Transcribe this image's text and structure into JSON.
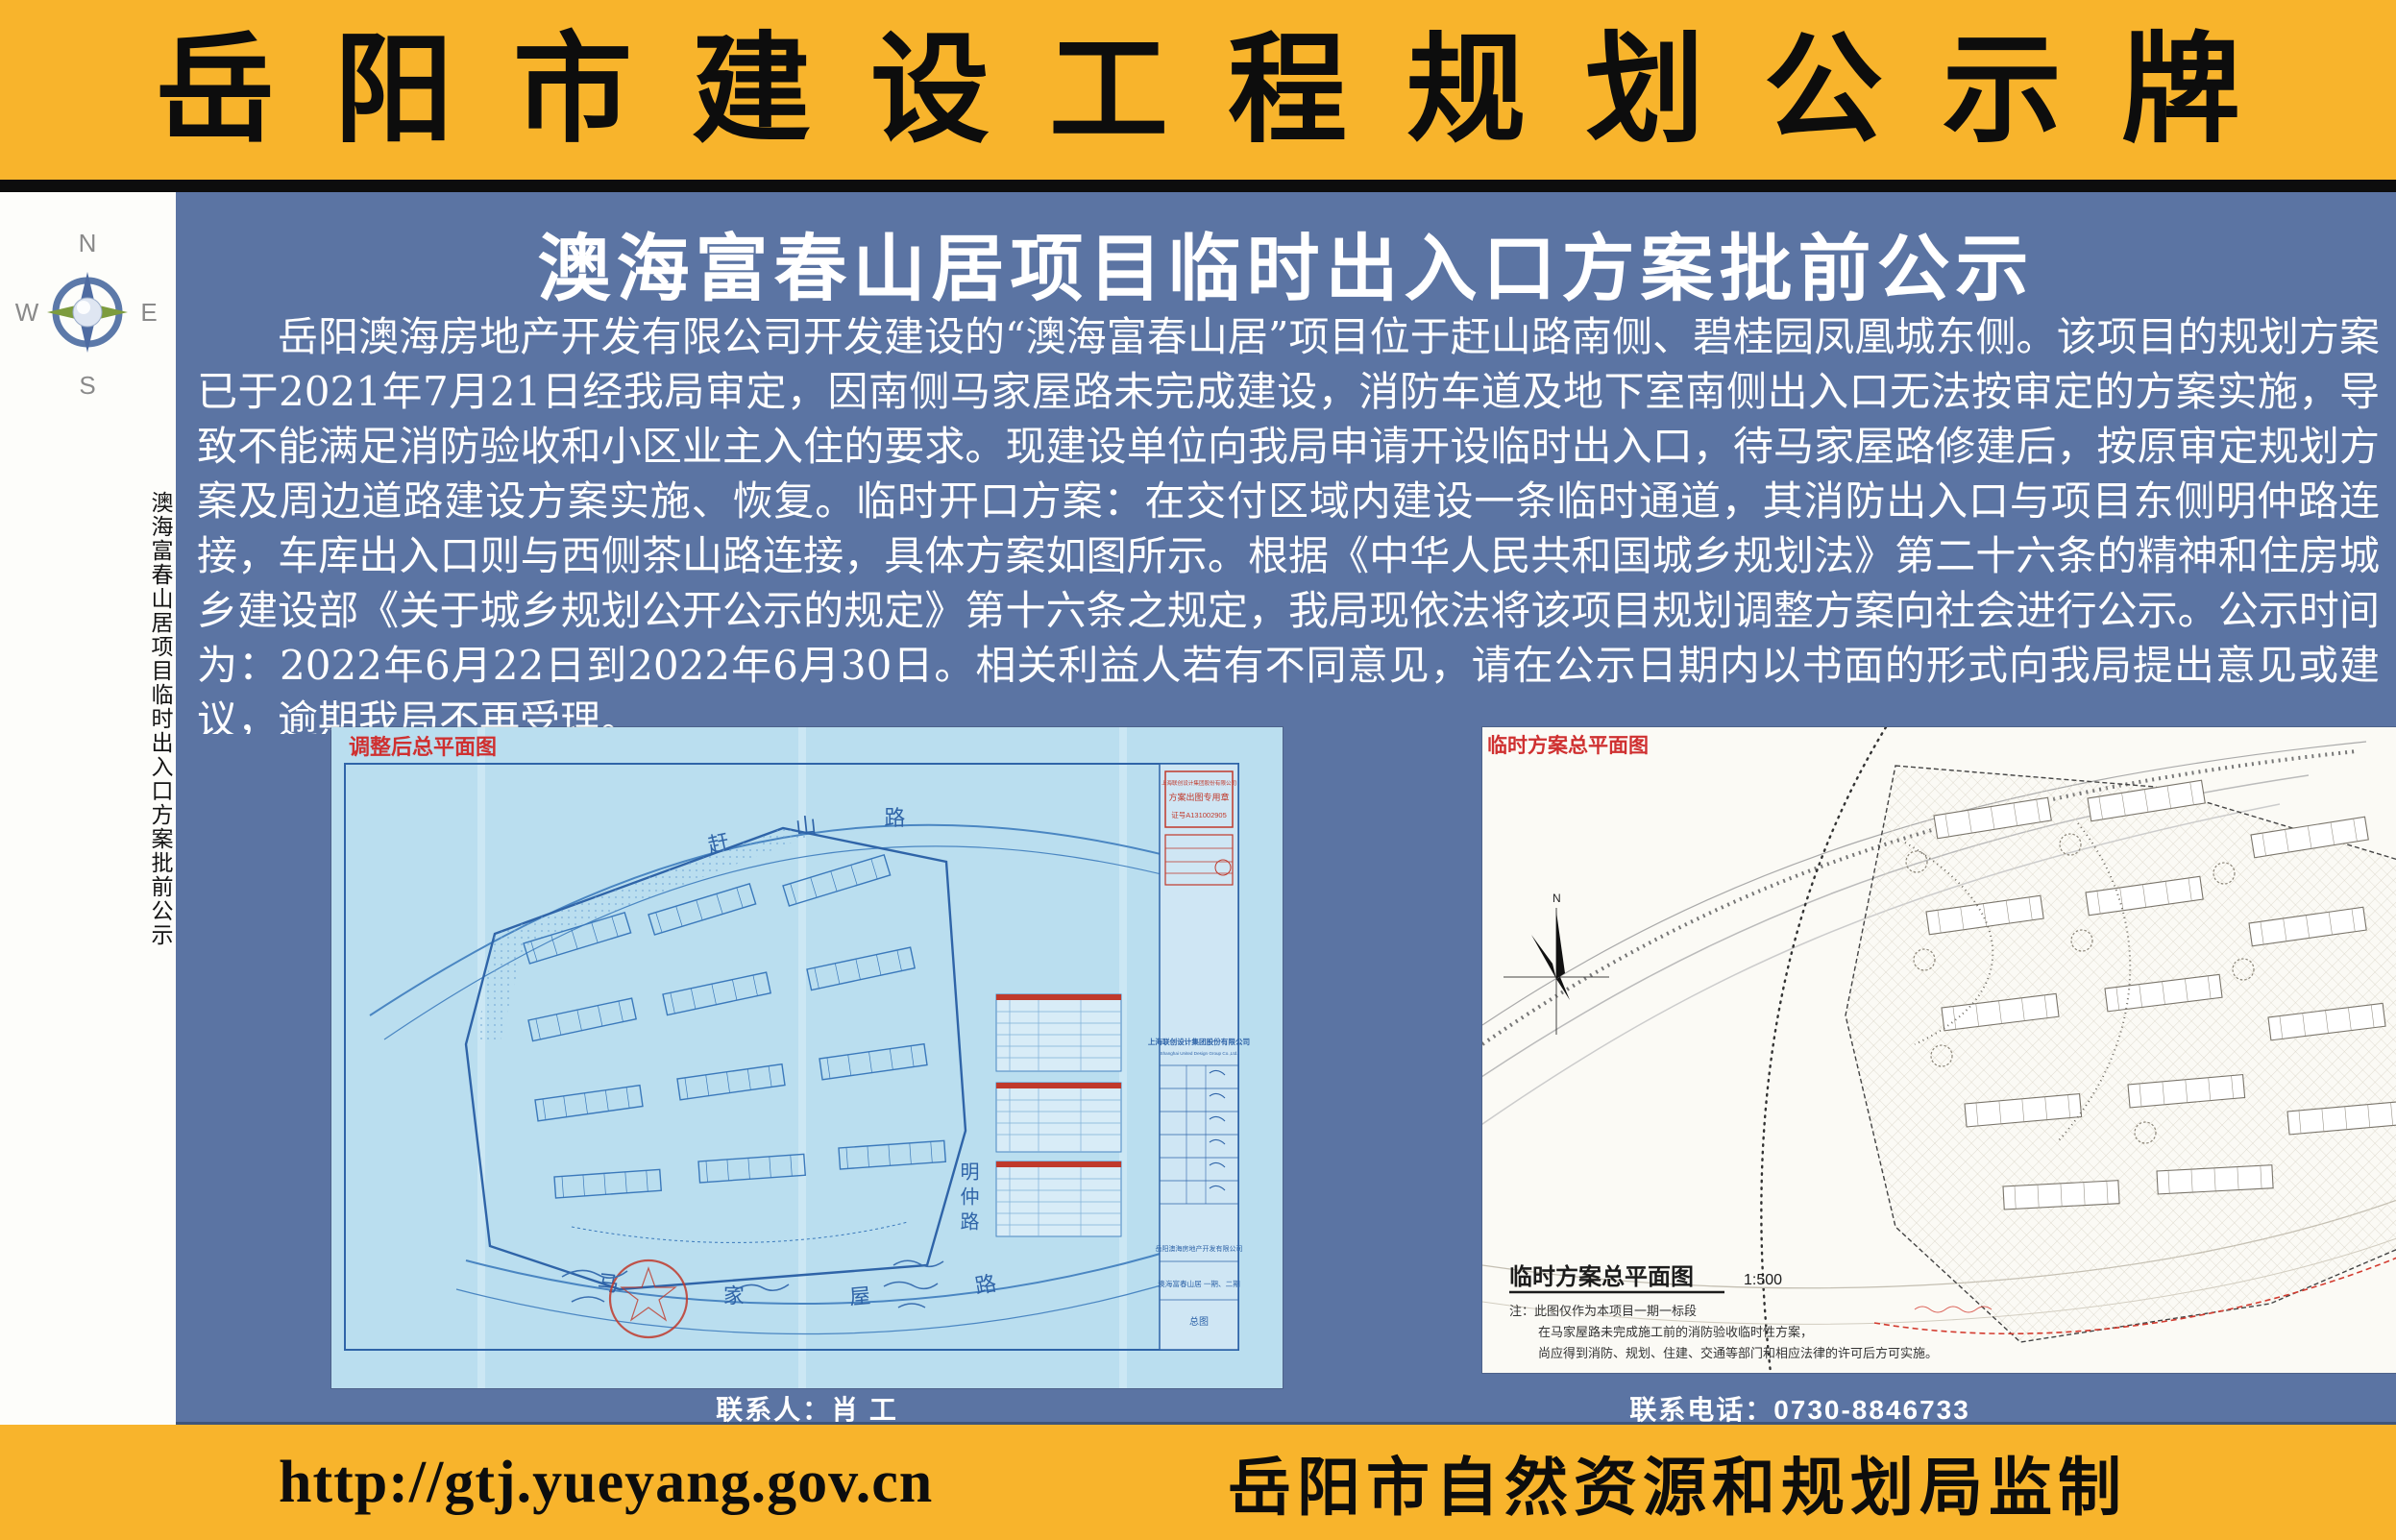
{
  "header": {
    "title": "岳阳市建设工程规划公示牌"
  },
  "sidebar": {
    "vertical_title": "澳海富春山居项目临时出入口方案批前公示",
    "compass": {
      "n": "N",
      "e": "E",
      "s": "S",
      "w": "W"
    }
  },
  "notice": {
    "subtitle": "澳海富春山居项目临时出入口方案批前公示",
    "body": "岳阳澳海房地产开发有限公司开发建设的“澳海富春山居”项目位于赶山路南侧、碧桂园凤凰城东侧。该项目的规划方案已于2021年7月21日经我局审定，因南侧马家屋路未完成建设，消防车道及地下室南侧出入口无法按审定的方案实施，导致不能满足消防验收和小区业主入住的要求。现建设单位向我局申请开设临时出入口，待马家屋路修建后，按原审定规划方案及周边道路建设方案实施、恢复。临时开口方案：在交付区域内建设一条临时通道，其消防出入口与项目东侧明仲路连接，车库出入口则与西侧茶山路连接，具体方案如图所示。根据《中华人民共和国城乡规划法》第二十六条的精神和住房城乡建设部《关于城乡规划公开公示的规定》第十六条之规定，我局现依法将该项目规划调整方案向社会进行公示。公示时间为：2022年6月22日到2022年6月30日。相关利益人若有不同意见，请在公示日期内以书面的形式向我局提出意见或建议，逾期我局不再受理。"
  },
  "plans": {
    "left": {
      "corner_label": "调整后总平面图",
      "road_top": "赶山路",
      "road_bottom": "马家屋路",
      "road_right": "明仲路",
      "stamp": [
        "上海联创设计集团股份有限公司",
        "方案出图专用章",
        "证号A131002905"
      ],
      "firm_cn": "上海联创设计集团股份有限公司",
      "firm_en": "Shanghai United Design Group Co.,Ltd.",
      "client": "岳阳澳海房地产开发有限公司",
      "project": "澳海富春山居 一期、二期",
      "sheet": "总图"
    },
    "right": {
      "corner_label": "临时方案总平面图",
      "legend_title": "临时方案总平面图",
      "legend_scale": "1:500",
      "legend_notes": [
        "注：此图仅作为本项目一期一标段",
        "在马家屋路未完成施工前的消防验收临时性方案，",
        "尚应得到消防、规划、住建、交通等部门和相应法律的许可后方可实施。"
      ]
    }
  },
  "contacts": {
    "person": "联系人：肖  工",
    "phone": "联系电话：0730-8846733"
  },
  "footer": {
    "url": "http://gtj.yueyang.gov.cn",
    "issuer": "岳阳市自然资源和规划局监制"
  },
  "colors": {
    "band_yellow": "#f8b42c",
    "panel_blue": "#5b74a3",
    "sidebar_white": "#fdfdfa",
    "divider_black": "#0d0d0d",
    "blueprint_paper": "#badeef",
    "blueprint_line": "#3b79bb",
    "cad_paper": "#fbfaf5",
    "red_label": "#cf3030"
  }
}
